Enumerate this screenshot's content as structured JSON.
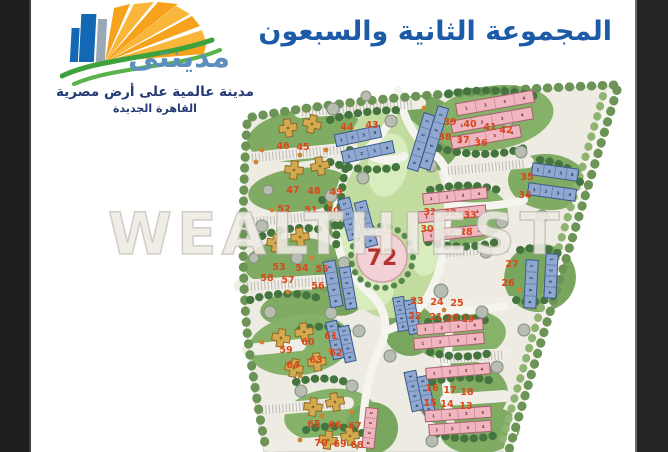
{
  "page": {
    "watermark": "WEALTHIEST"
  },
  "branding": {
    "logo_name_ar": "مدينتى",
    "logo_tagline_ar": "مدينة عالمية على أرض مصرية",
    "logo_subtitle_ar": "القاهرة الجديدة"
  },
  "header": {
    "title_ar": "المجموعة الثانية والسبعون"
  },
  "colors": {
    "title_blue": "#1d5ba8",
    "logo_blue": "#5c8fbe",
    "logo_navy": "#233a74",
    "lot_number_red": "#dc4619",
    "group_number_red": "#b5322c",
    "apartment_blue": "#90a8cf",
    "apartment_pink": "#efb6bf",
    "villa_yellow": "#d4a94f"
  },
  "map": {
    "group_label": "72",
    "lot_number_color": "#dc4619",
    "group_label_color": "#b5322c",
    "palette": {
      "b_fill": "#90a8cf",
      "b_stroke": "#39598c",
      "b_div": "#5d7cab",
      "b_digit": "#1d3a66",
      "p_fill": "#efb6bf",
      "p_stroke": "#a65f6d",
      "p_div": "#c98b96",
      "p_digit": "#7c2731",
      "v_fill": "#d4a94f",
      "v_stroke": "#8f6a24"
    },
    "unit_numbers": [
      "1",
      "2",
      "3",
      "4"
    ],
    "lots": [
      {
        "n": "44",
        "x": 347,
        "y": 127
      },
      {
        "n": "43",
        "x": 372,
        "y": 125
      },
      {
        "n": "39",
        "x": 450,
        "y": 122
      },
      {
        "n": "40",
        "x": 470,
        "y": 124
      },
      {
        "n": "41",
        "x": 490,
        "y": 127
      },
      {
        "n": "42",
        "x": 506,
        "y": 130
      },
      {
        "n": "38",
        "x": 445,
        "y": 137
      },
      {
        "n": "37",
        "x": 463,
        "y": 140
      },
      {
        "n": "36",
        "x": 481,
        "y": 143
      },
      {
        "n": "35",
        "x": 527,
        "y": 177
      },
      {
        "n": "34",
        "x": 525,
        "y": 195
      },
      {
        "n": "31",
        "x": 430,
        "y": 212
      },
      {
        "n": "32",
        "x": 450,
        "y": 213
      },
      {
        "n": "33",
        "x": 470,
        "y": 215
      },
      {
        "n": "30",
        "x": 427,
        "y": 229
      },
      {
        "n": "29",
        "x": 448,
        "y": 231
      },
      {
        "n": "28",
        "x": 466,
        "y": 232
      },
      {
        "n": "27",
        "x": 512,
        "y": 264
      },
      {
        "n": "26",
        "x": 508,
        "y": 283
      },
      {
        "n": "46",
        "x": 283,
        "y": 146
      },
      {
        "n": "45",
        "x": 303,
        "y": 147
      },
      {
        "n": "47",
        "x": 293,
        "y": 190
      },
      {
        "n": "48",
        "x": 314,
        "y": 191
      },
      {
        "n": "49",
        "x": 336,
        "y": 192
      },
      {
        "n": "52",
        "x": 284,
        "y": 209
      },
      {
        "n": "51",
        "x": 311,
        "y": 210
      },
      {
        "n": "50",
        "x": 333,
        "y": 211
      },
      {
        "n": "53",
        "x": 279,
        "y": 267
      },
      {
        "n": "54",
        "x": 302,
        "y": 268
      },
      {
        "n": "55",
        "x": 322,
        "y": 269
      },
      {
        "n": "58",
        "x": 267,
        "y": 278
      },
      {
        "n": "57",
        "x": 288,
        "y": 280
      },
      {
        "n": "56",
        "x": 318,
        "y": 286
      },
      {
        "n": "59",
        "x": 286,
        "y": 350
      },
      {
        "n": "60",
        "x": 308,
        "y": 342
      },
      {
        "n": "61",
        "x": 331,
        "y": 336
      },
      {
        "n": "64",
        "x": 293,
        "y": 365
      },
      {
        "n": "63",
        "x": 316,
        "y": 360
      },
      {
        "n": "62",
        "x": 336,
        "y": 353
      },
      {
        "n": "65",
        "x": 314,
        "y": 424
      },
      {
        "n": "66",
        "x": 335,
        "y": 425
      },
      {
        "n": "67",
        "x": 355,
        "y": 426
      },
      {
        "n": "70",
        "x": 321,
        "y": 443
      },
      {
        "n": "69",
        "x": 340,
        "y": 444
      },
      {
        "n": "68",
        "x": 357,
        "y": 445
      },
      {
        "n": "23",
        "x": 417,
        "y": 301
      },
      {
        "n": "24",
        "x": 437,
        "y": 302
      },
      {
        "n": "25",
        "x": 457,
        "y": 303
      },
      {
        "n": "22",
        "x": 415,
        "y": 316
      },
      {
        "n": "21",
        "x": 436,
        "y": 317
      },
      {
        "n": "20",
        "x": 452,
        "y": 318
      },
      {
        "n": "19",
        "x": 468,
        "y": 319
      },
      {
        "n": "16",
        "x": 432,
        "y": 388
      },
      {
        "n": "17",
        "x": 450,
        "y": 390
      },
      {
        "n": "18",
        "x": 467,
        "y": 392
      },
      {
        "n": "15",
        "x": 430,
        "y": 403
      },
      {
        "n": "14",
        "x": 447,
        "y": 404
      },
      {
        "n": "13",
        "x": 466,
        "y": 406
      }
    ],
    "buildings": [
      {
        "t": "b",
        "x": 358,
        "y": 136,
        "l": 46,
        "w": 12,
        "r": -12
      },
      {
        "t": "b",
        "x": 368,
        "y": 152,
        "l": 52,
        "w": 12,
        "r": -12
      },
      {
        "t": "b",
        "x": 434,
        "y": 138,
        "l": 64,
        "w": 11,
        "r": 107
      },
      {
        "t": "b",
        "x": 421,
        "y": 142,
        "l": 58,
        "w": 11,
        "r": 107
      },
      {
        "t": "b",
        "x": 555,
        "y": 172,
        "l": 46,
        "w": 12,
        "r": 8
      },
      {
        "t": "b",
        "x": 552,
        "y": 192,
        "l": 48,
        "w": 12,
        "r": 8
      },
      {
        "t": "b",
        "x": 531,
        "y": 284,
        "l": 48,
        "w": 12,
        "r": 93
      },
      {
        "t": "b",
        "x": 551,
        "y": 276,
        "l": 44,
        "w": 12,
        "r": 93
      },
      {
        "t": "b",
        "x": 349,
        "y": 219,
        "l": 42,
        "w": 12,
        "r": 75
      },
      {
        "t": "b",
        "x": 366,
        "y": 224,
        "l": 46,
        "w": 12,
        "r": 75
      },
      {
        "t": "b",
        "x": 333,
        "y": 284,
        "l": 46,
        "w": 12,
        "r": 80
      },
      {
        "t": "b",
        "x": 348,
        "y": 288,
        "l": 42,
        "w": 11,
        "r": 80
      },
      {
        "t": "b",
        "x": 335,
        "y": 340,
        "l": 38,
        "w": 11,
        "r": 78
      },
      {
        "t": "b",
        "x": 347,
        "y": 344,
        "l": 36,
        "w": 11,
        "r": 78
      },
      {
        "t": "b",
        "x": 401,
        "y": 314,
        "l": 34,
        "w": 11,
        "r": 80
      },
      {
        "t": "b",
        "x": 412,
        "y": 317,
        "l": 34,
        "w": 11,
        "r": 80
      },
      {
        "t": "b",
        "x": 414,
        "y": 391,
        "l": 40,
        "w": 12,
        "r": 78
      },
      {
        "t": "b",
        "x": 426,
        "y": 395,
        "l": 38,
        "w": 11,
        "r": 78
      },
      {
        "t": "p",
        "x": 495,
        "y": 103,
        "l": 78,
        "w": 12,
        "r": -10
      },
      {
        "t": "p",
        "x": 492,
        "y": 120,
        "l": 82,
        "w": 12,
        "r": -10
      },
      {
        "t": "p",
        "x": 486,
        "y": 137,
        "l": 70,
        "w": 12,
        "r": -10
      },
      {
        "t": "p",
        "x": 455,
        "y": 196,
        "l": 64,
        "w": 11,
        "r": -6
      },
      {
        "t": "p",
        "x": 452,
        "y": 214,
        "l": 68,
        "w": 11,
        "r": -6
      },
      {
        "t": "p",
        "x": 455,
        "y": 233,
        "l": 64,
        "w": 11,
        "r": -6
      },
      {
        "t": "p",
        "x": 450,
        "y": 327,
        "l": 66,
        "w": 11,
        "r": -5
      },
      {
        "t": "p",
        "x": 449,
        "y": 341,
        "l": 70,
        "w": 11,
        "r": -5
      },
      {
        "t": "p",
        "x": 458,
        "y": 371,
        "l": 64,
        "w": 11,
        "r": -5
      },
      {
        "t": "p",
        "x": 458,
        "y": 414,
        "l": 66,
        "w": 11,
        "r": -4
      },
      {
        "t": "p",
        "x": 460,
        "y": 428,
        "l": 62,
        "w": 11,
        "r": -4
      },
      {
        "t": "p",
        "x": 370,
        "y": 428,
        "l": 40,
        "w": 12,
        "r": 96
      },
      {
        "t": "v",
        "x": 288,
        "y": 128,
        "r": -10
      },
      {
        "t": "v",
        "x": 312,
        "y": 124,
        "r": 14
      },
      {
        "t": "v",
        "x": 294,
        "y": 170,
        "r": 6
      },
      {
        "t": "v",
        "x": 320,
        "y": 166,
        "r": -12
      },
      {
        "t": "v",
        "x": 276,
        "y": 243,
        "r": 8
      },
      {
        "t": "v",
        "x": 300,
        "y": 237,
        "r": -6
      },
      {
        "t": "v",
        "x": 281,
        "y": 338,
        "r": 10
      },
      {
        "t": "v",
        "x": 304,
        "y": 332,
        "r": -8
      },
      {
        "t": "v",
        "x": 294,
        "y": 368,
        "r": 12
      },
      {
        "t": "v",
        "x": 317,
        "y": 362,
        "r": -6
      },
      {
        "t": "v",
        "x": 313,
        "y": 407,
        "r": 6
      },
      {
        "t": "v",
        "x": 335,
        "y": 402,
        "r": -12
      },
      {
        "t": "v",
        "x": 328,
        "y": 440,
        "r": 8
      },
      {
        "t": "v",
        "x": 350,
        "y": 436,
        "r": -8
      }
    ]
  }
}
